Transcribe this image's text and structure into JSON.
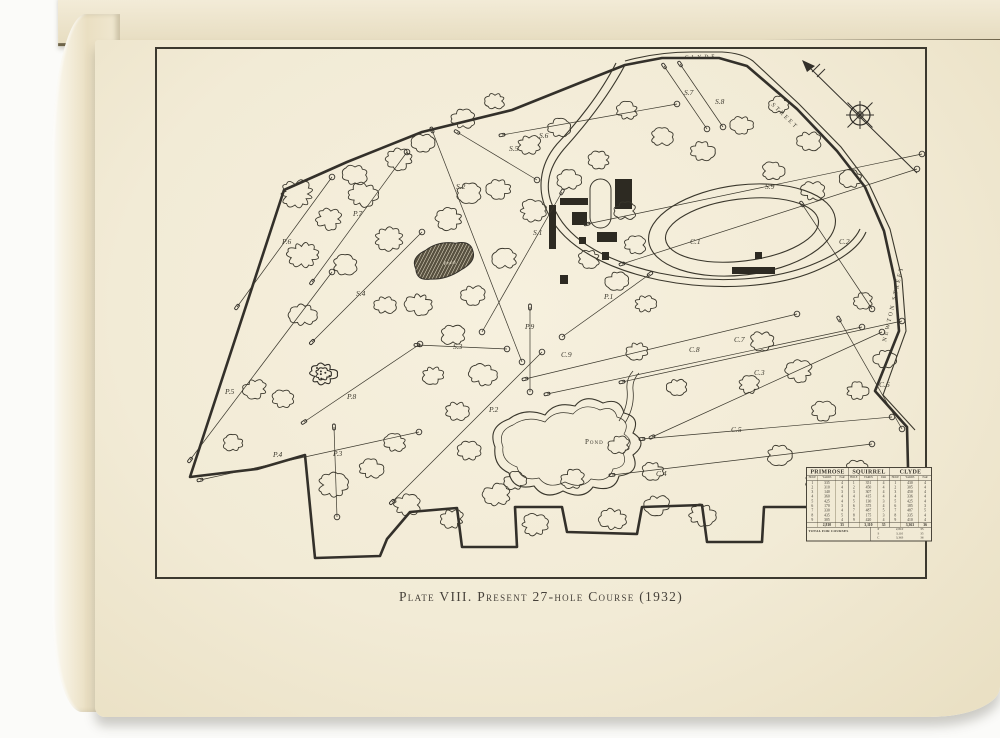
{
  "photo": {
    "caption": "Plate VIII. Present 27-hole Course (1932)"
  },
  "map": {
    "street_labels": [
      {
        "text": "CLYDE",
        "x": 528,
        "y": 10,
        "r": -2,
        "cls": "clyde"
      },
      {
        "text": "STREET",
        "x": 614,
        "y": 56,
        "r": 44,
        "cls": "street"
      },
      {
        "text": "NEWTON STREET",
        "x": 729,
        "y": 293,
        "r": -77,
        "cls": "street"
      }
    ],
    "pond_labels": [
      {
        "text": "Pond",
        "x": 287,
        "y": 216,
        "r": -8,
        "cls": "pond-small"
      },
      {
        "text": "Pond",
        "x": 428,
        "y": 395,
        "r": 0,
        "cls": "pond-big"
      }
    ],
    "hole_labels": [
      {
        "text": "P.1",
        "x": 447,
        "y": 250
      },
      {
        "text": "P.2",
        "x": 332,
        "y": 363
      },
      {
        "text": "P.3",
        "x": 176,
        "y": 407
      },
      {
        "text": "P.4",
        "x": 116,
        "y": 408
      },
      {
        "text": "P.5",
        "x": 68,
        "y": 345
      },
      {
        "text": "P.6",
        "x": 125,
        "y": 195
      },
      {
        "text": "P.7",
        "x": 196,
        "y": 167
      },
      {
        "text": "P.8",
        "x": 190,
        "y": 350
      },
      {
        "text": "P.9",
        "x": 368,
        "y": 280
      },
      {
        "text": "S.1",
        "x": 376,
        "y": 186
      },
      {
        "text": "S.2",
        "x": 299,
        "y": 140
      },
      {
        "text": "S.3",
        "x": 296,
        "y": 300
      },
      {
        "text": "S.4",
        "x": 199,
        "y": 247
      },
      {
        "text": "S.5",
        "x": 352,
        "y": 102
      },
      {
        "text": "S.6",
        "x": 382,
        "y": 89
      },
      {
        "text": "S.7",
        "x": 527,
        "y": 46
      },
      {
        "text": "S.8",
        "x": 558,
        "y": 55
      },
      {
        "text": "S.9",
        "x": 608,
        "y": 140
      },
      {
        "text": "C.1",
        "x": 533,
        "y": 195
      },
      {
        "text": "C.2",
        "x": 682,
        "y": 195
      },
      {
        "text": "C.3",
        "x": 597,
        "y": 326
      },
      {
        "text": "C.4",
        "x": 499,
        "y": 427
      },
      {
        "text": "C.5",
        "x": 574,
        "y": 383
      },
      {
        "text": "C.6",
        "x": 722,
        "y": 338
      },
      {
        "text": "C.7",
        "x": 577,
        "y": 293
      },
      {
        "text": "C.8",
        "x": 532,
        "y": 303
      },
      {
        "text": "C.9",
        "x": 404,
        "y": 308
      }
    ],
    "compass": "north-arrow"
  },
  "scorecard": {
    "columns": [
      "HOLE",
      "YARDS",
      "PAR"
    ],
    "courses": [
      {
        "name": "PRIMROSE",
        "rows": [
          [
            "1",
            "335",
            "4"
          ],
          [
            "2",
            "310",
            "4"
          ],
          [
            "3",
            "140",
            "3"
          ],
          [
            "4",
            "360",
            "4"
          ],
          [
            "5",
            "425",
            "4"
          ],
          [
            "6",
            "170",
            "3"
          ],
          [
            "7",
            "330",
            "4"
          ],
          [
            "8",
            "435",
            "5"
          ],
          [
            "9",
            "305",
            "4"
          ]
        ],
        "total": [
          "",
          "2,810",
          "35"
        ]
      },
      {
        "name": "SQUIRREL",
        "rows": [
          [
            "1",
            "351",
            "4"
          ],
          [
            "2",
            "450",
            "4"
          ],
          [
            "3",
            "307",
            "4"
          ],
          [
            "4",
            "415",
            "4"
          ],
          [
            "5",
            "130",
            "3"
          ],
          [
            "6",
            "375",
            "4"
          ],
          [
            "7",
            "487",
            "5"
          ],
          [
            "8",
            "175",
            "3"
          ],
          [
            "9",
            "420",
            "4"
          ]
        ],
        "total": [
          "",
          "3,110",
          "35"
        ]
      },
      {
        "name": "CLYDE",
        "rows": [
          [
            "1",
            "430",
            "4"
          ],
          [
            "2",
            "305",
            "4"
          ],
          [
            "3",
            "450",
            "4"
          ],
          [
            "4",
            "336",
            "4"
          ],
          [
            "5",
            "425",
            "4"
          ],
          [
            "6",
            "185",
            "3"
          ],
          [
            "7",
            "487",
            "5"
          ],
          [
            "8",
            "335",
            "4"
          ],
          [
            "9",
            "410",
            "4"
          ]
        ],
        "total": [
          "",
          "3,363",
          "36"
        ]
      }
    ],
    "footer_label": "TOTAL FOR COURSES",
    "footer_rows": [
      [
        "P",
        "2,810",
        "35"
      ],
      [
        "S",
        "3,110",
        "35"
      ],
      [
        "C",
        "3,363",
        "36"
      ]
    ]
  }
}
